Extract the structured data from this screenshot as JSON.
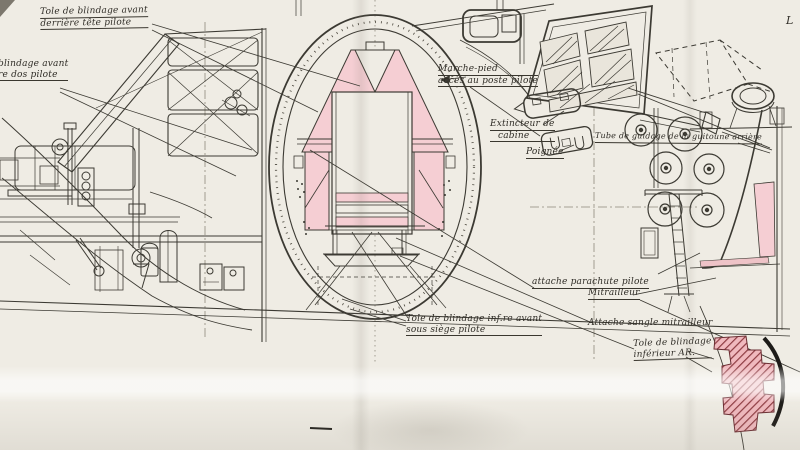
{
  "drawing": {
    "type": "aircraft-technical-blueprint",
    "language": "fr",
    "labels": {
      "blindage_tete": {
        "line1": "Tole de blindage avant",
        "line2": "derrière tête pilote"
      },
      "blindage_dos": {
        "line1": "blindage avant",
        "line2": "re dos pilote"
      },
      "marchepied": {
        "line1": "Marche-pied",
        "line2": "accès au poste pilote"
      },
      "extincteur": {
        "line1": "Extincteur de",
        "line2": "cabine"
      },
      "poignee": {
        "line1": "Poignée"
      },
      "tube_guidage": {
        "line1": "Tube de guidage de la guitoune arrière"
      },
      "attache_parachute": {
        "line1": "attache parachute pilote"
      },
      "mitrailleur": {
        "line1": "Mitrailleur"
      },
      "attache_sangle": {
        "line1": "Attache sangle mitrailleur"
      },
      "blindage_inf_avant": {
        "line1": "Tole de blindage inf.re avant",
        "line2": "sous siège pilote"
      },
      "blindage_inf_ar": {
        "line1": "Tole de blindage",
        "line2": "inférieur AR."
      },
      "edge_fragment": {
        "line1": "L"
      }
    },
    "colors": {
      "paper": "#efece4",
      "ink": "#3a372f",
      "armor_pink": "#f5ced3",
      "armor_hatch_red": "#8e3b42",
      "arc_black": "#1d1b18"
    }
  }
}
